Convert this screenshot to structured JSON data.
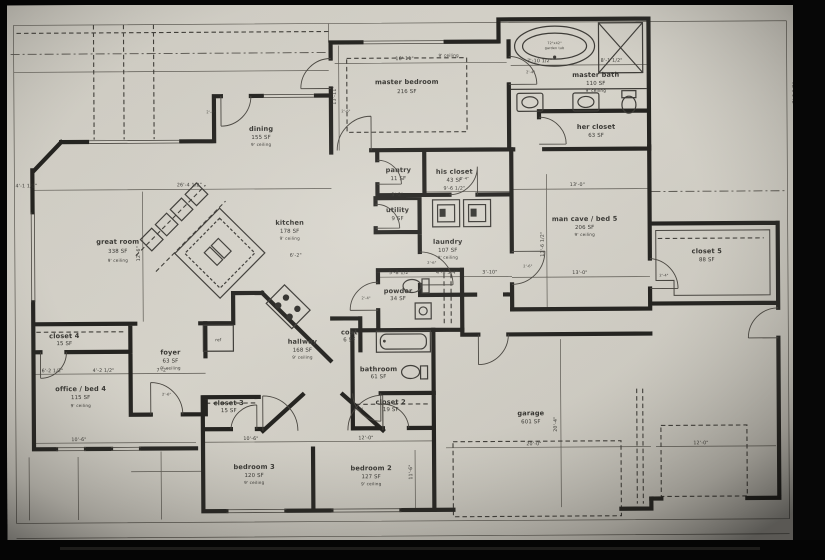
{
  "meta": {
    "drawing_type": "residential floor plan (photo of screen)",
    "paper_color": "#d6d3ca",
    "wall_color": "#201f1c",
    "line_color": "#57544d",
    "text_color": "#33322e"
  },
  "rooms": {
    "master_bedroom": {
      "name": "master bedroom",
      "area": "216 SF",
      "ceiling": "9' ceiling"
    },
    "master_bath": {
      "name": "master bath",
      "area": "110 SF",
      "ceiling": "9' ceiling"
    },
    "her_closet": {
      "name": "her closet",
      "area": "63 SF"
    },
    "his_closet": {
      "name": "his closet",
      "area": "43 SF"
    },
    "pantry": {
      "name": "pantry",
      "area": "11 SF"
    },
    "utility": {
      "name": "utility",
      "area": "9 SF"
    },
    "laundry": {
      "name": "laundry",
      "area": "107 SF",
      "ceiling": "9' ceiling"
    },
    "dining": {
      "name": "dining",
      "area": "155 SF",
      "ceiling": "9' ceiling"
    },
    "kitchen": {
      "name": "kitchen",
      "area": "178 SF",
      "ceiling": "9' ceiling"
    },
    "great_room": {
      "name": "great room",
      "area": "338 SF",
      "ceiling": "9' ceiling"
    },
    "man_cave": {
      "name": "man cave / bed 5",
      "area": "206 SF",
      "ceiling": "9' ceiling"
    },
    "closet_5": {
      "name": "closet 5",
      "area": "88 SF"
    },
    "powder": {
      "name": "powder",
      "area": "34 SF"
    },
    "hallway": {
      "name": "hallway",
      "area": "168 SF",
      "ceiling": "9' ceiling"
    },
    "coat": {
      "name": "coat",
      "area": "6 SF"
    },
    "bathroom": {
      "name": "bathroom",
      "area": "61 SF"
    },
    "closet_4": {
      "name": "closet 4",
      "area": "15 SF"
    },
    "office_bed4": {
      "name": "office / bed 4",
      "area": "115 SF",
      "ceiling": "9' ceiling"
    },
    "foyer": {
      "name": "foyer",
      "area": "63 SF",
      "ceiling": "9' ceiling"
    },
    "closet_3": {
      "name": "closet 3",
      "area": "15 SF"
    },
    "closet_2": {
      "name": "closet 2",
      "area": "19 SF"
    },
    "bedroom_3": {
      "name": "bedroom 3",
      "area": "120 SF",
      "ceiling": "9' ceiling"
    },
    "bedroom_2": {
      "name": "bedroom 2",
      "area": "127 SF",
      "ceiling": "9' ceiling"
    },
    "garage": {
      "name": "garage",
      "area": "601 SF"
    }
  },
  "fixtures": {
    "garden_tub_line1": "72\"x42\"",
    "garden_tub_line2": "garden tub",
    "refrigerator": "ref"
  },
  "dims": {
    "master_bedroom_width": "16'-11\"",
    "bath_left": "7'-10 1/2\"",
    "bath_right": "8'-1 1/2\"",
    "great_room_width": "26'-4 1/2\"",
    "left_offset": "4'-1 1/2\"",
    "his_closet_width": "9'-6 1/2\"",
    "man_cave_top": "13'-0\"",
    "man_cave_bottom": "13'-0\"",
    "utility_top": "3'-2\"",
    "kitchen_run": "6'-2\"",
    "powder_a": "5'-8 1/2\"",
    "powder_b": "4'-8 3/4\"",
    "powder_c": "3'-10\"",
    "office_a": "6'-2 1/2\"",
    "office_b": "4'-2 1/2\"",
    "foyer_width": "7'-2\"",
    "office_bottom": "10'-6\"",
    "bedroom3_width": "10'-6\"",
    "bedroom2_width": "12'-0\"",
    "garage_door": "20'-0\"",
    "garage_door2": "12'-0\"",
    "garage_depth": "20'-4\"",
    "bedroom2_height": "11'-6\"",
    "great_room_height": "12'-6\"",
    "master_left_height": "13'-11\"",
    "man_cave_height": "13'-6 1/2\"",
    "right_top": "7'-6 1/2\"",
    "closet5_right": "10'-6\"",
    "bottom_1": "9'-5\"",
    "bottom_2": "3'-4 1/2\"",
    "bottom_3": "3'-4 1/2\"",
    "bottom_4": "9'-5\"",
    "bottom_5": "5'-5\"",
    "bottom_6": "8'-2\"",
    "bottom_7": "8'-2\""
  },
  "door_tags": {
    "a": "2'-6\"",
    "b": "2'-4\""
  }
}
